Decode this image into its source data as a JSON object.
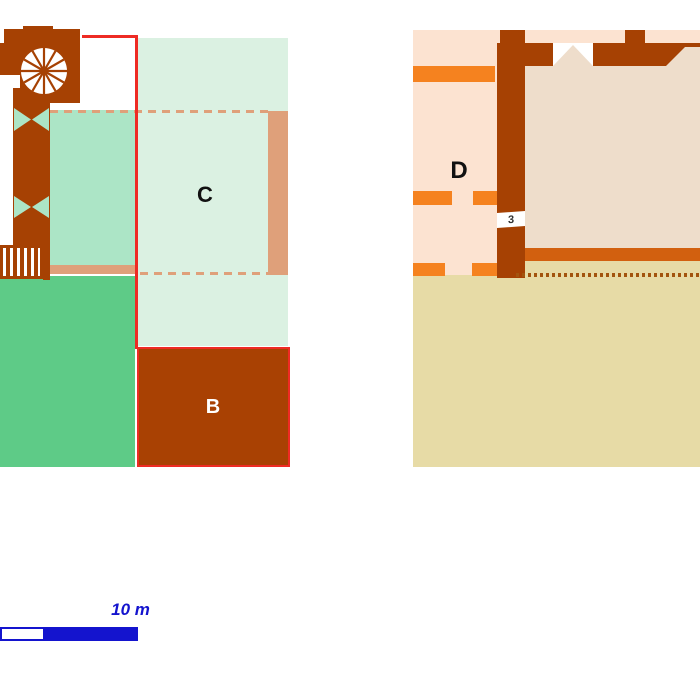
{
  "diagram": {
    "type": "archaeological-floor-plan",
    "labels": {
      "area_b": "B",
      "area_c": "C",
      "area_d": "D",
      "room_3": "3"
    },
    "scale_bar": {
      "label": "10 m"
    },
    "palette": {
      "wall_brown": "#A64103",
      "area_b_brown": "#A94103",
      "mint_light": "#DBF1E2",
      "mint_medium": "#ACE5C6",
      "green": "#5ECB87",
      "salmon": "#DFA07A",
      "outline_red": "#EE2B24",
      "peach": "#FCE3D1",
      "room_beige": "#EEDDCB",
      "orange": "#F5821F",
      "dark_orange": "#D2600F",
      "tan": "#E7DBA6",
      "scale_blue": "#1414CE"
    }
  }
}
